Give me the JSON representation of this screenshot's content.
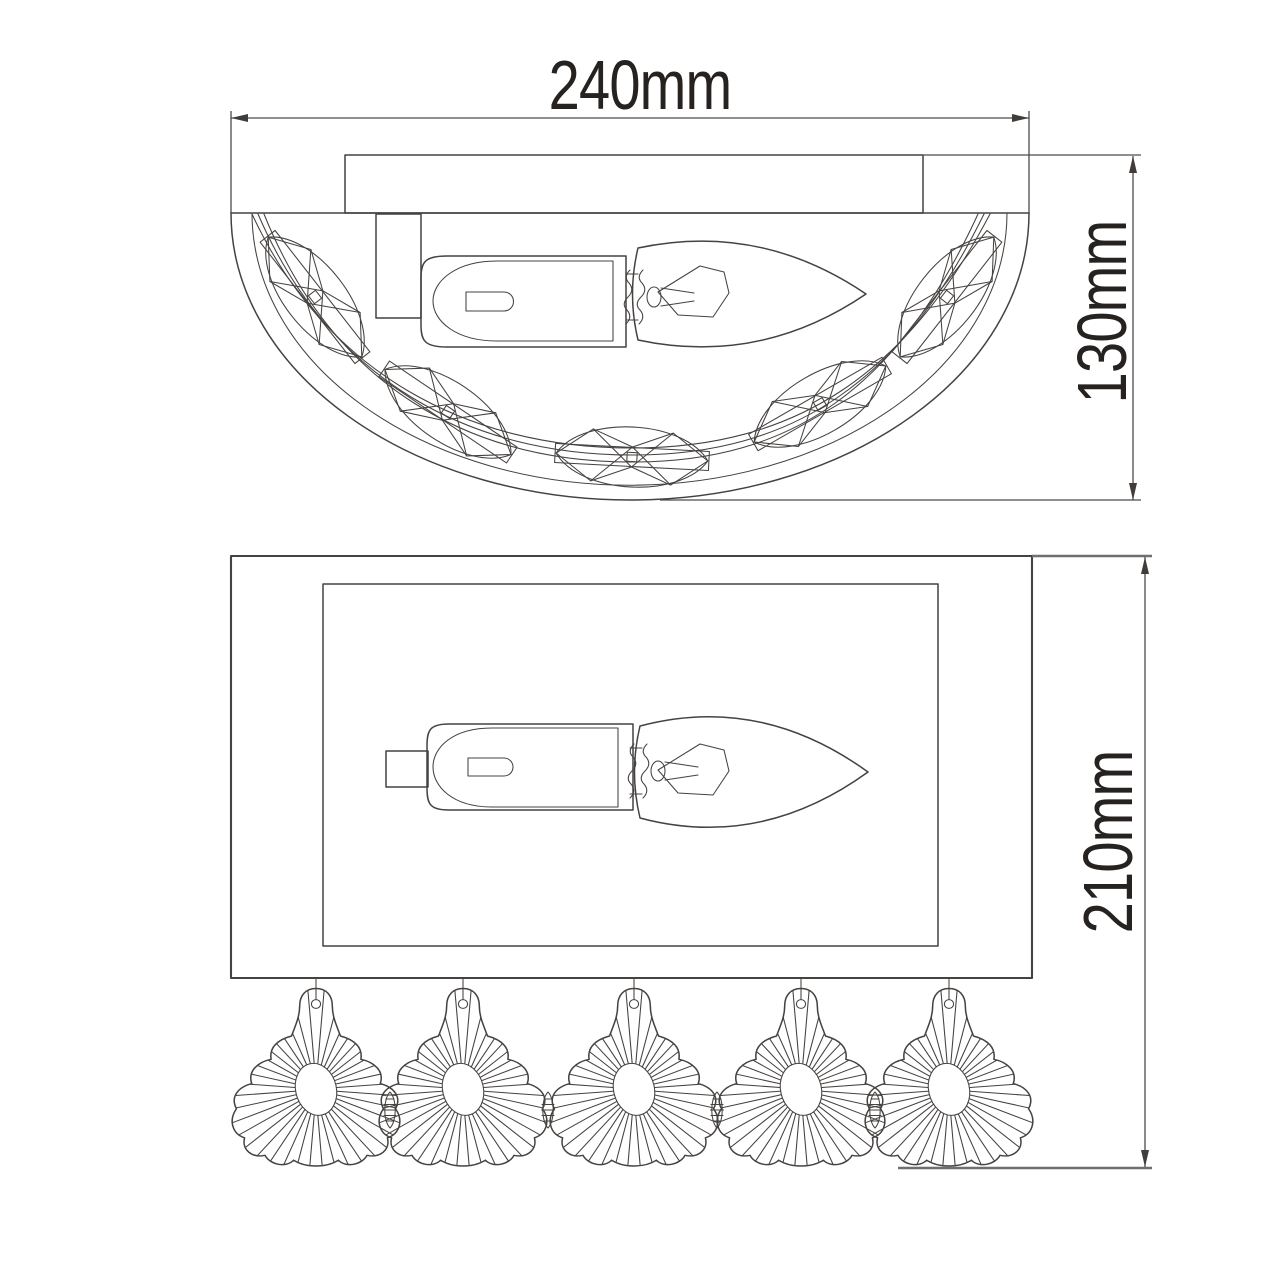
{
  "drawing": {
    "title": "wall sconce technical drawing, two orthographic views",
    "background": "#ffffff",
    "stroke_color": "#454240",
    "text_color": "#262220",
    "dimensions": {
      "width": {
        "label": "240mm",
        "orientation": "horizontal",
        "view": "top"
      },
      "depth": {
        "label": "130mm",
        "orientation": "vertical",
        "view": "top"
      },
      "height": {
        "label": "210mm",
        "orientation": "vertical",
        "view": "front"
      }
    },
    "views": {
      "top": {
        "crystals": 5,
        "bulbs": 1
      },
      "front": {
        "pendants": 5,
        "bulbs": 1
      }
    }
  }
}
